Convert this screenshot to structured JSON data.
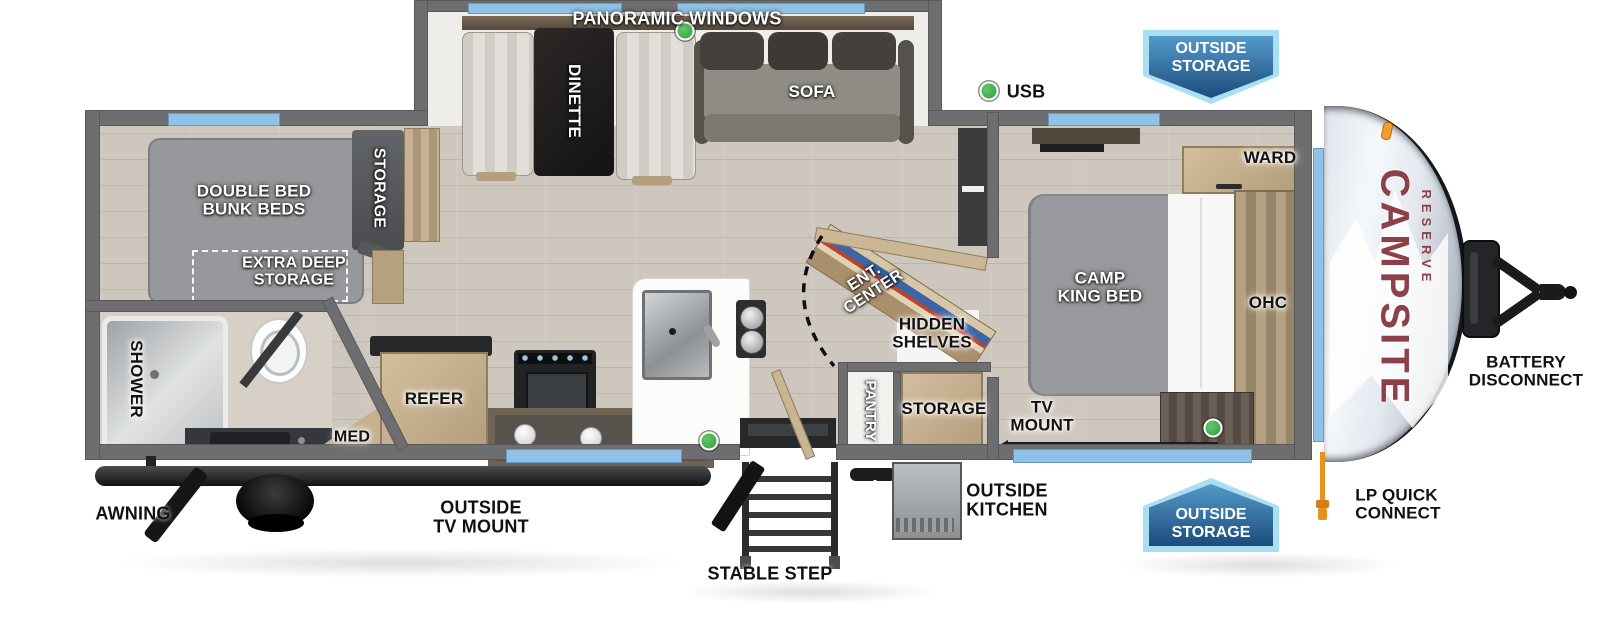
{
  "brand": {
    "primary": "CAMPSITE",
    "secondary": "RESERVE"
  },
  "badges": {
    "top": "OUTSIDE\nSTORAGE",
    "bottom": "OUTSIDE\nSTORAGE"
  },
  "labels": {
    "panoramic_windows": "PANORAMIC WINDOWS",
    "dinette": "DINETTE",
    "sofa": "SOFA",
    "usb": "USB",
    "double_bed": "DOUBLE BED\nBUNK BEDS",
    "storage_rear": "STORAGE",
    "extra_deep": "EXTRA DEEP\nSTORAGE",
    "shower": "SHOWER",
    "med": "MED",
    "refer": "REFER",
    "ent_center": "ENT.\nCENTER",
    "hidden_shelves": "HIDDEN\nSHELVES",
    "pantry": "PANTRY",
    "storage_mid": "STORAGE",
    "camp_king": "CAMP\nKING BED",
    "ward": "WARD",
    "ohc": "OHC",
    "tv_mount": "TV\nMOUNT",
    "battery": "BATTERY\nDISCONNECT",
    "awning": "AWNING",
    "outside_tv": "OUTSIDE\nTV MOUNT",
    "stable_step": "STABLE STEP",
    "outside_kitchen": "OUTSIDE\nKITCHEN",
    "lp_quick": "LP QUICK\nCONNECT"
  },
  "colors": {
    "wall_gray": "#6e6e70",
    "window_blue": "#8fc2e6",
    "badge_blue": "#1b4c7c",
    "badge_border": "#a8dff2",
    "indicator_green": "#2e9e3a",
    "brand_maroon": "#8c4149",
    "lp_orange": "#e8921c",
    "bed_gray": "#97999d",
    "cabinet_wood": "#c3ae8d"
  }
}
